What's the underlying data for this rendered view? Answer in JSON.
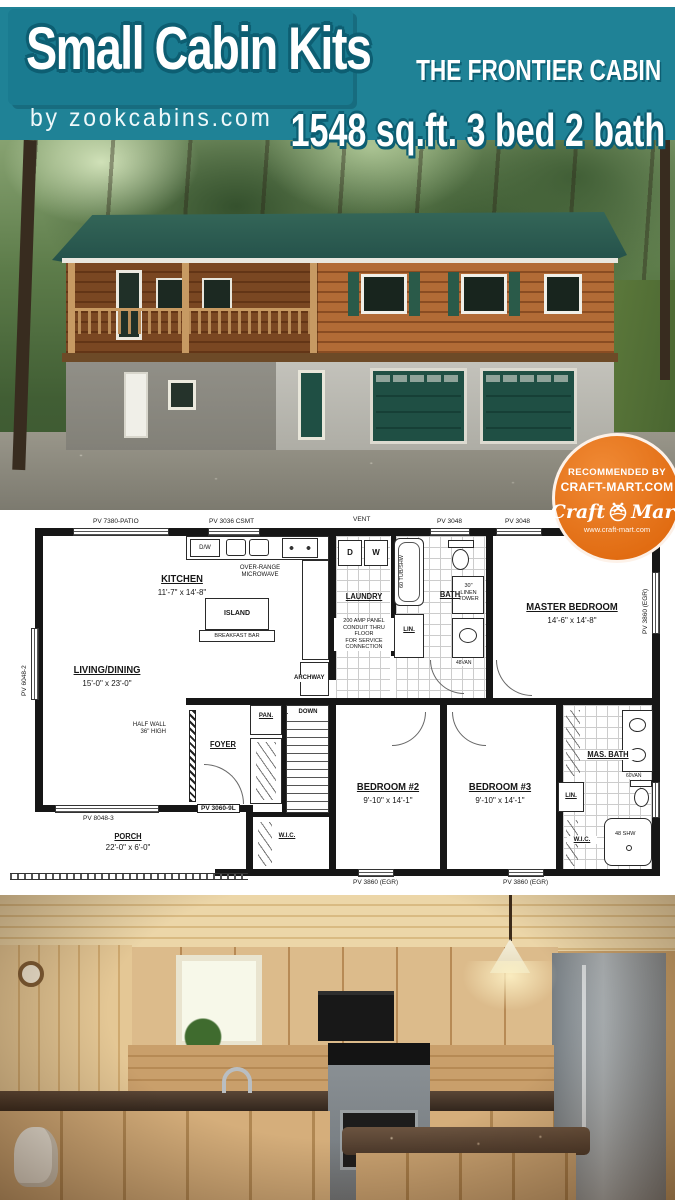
{
  "header": {
    "title": "Small Cabin Kits",
    "byline": "by zookcabins.com",
    "model_name": "THE FRONTIER CABIN",
    "specs": "1548 sq.ft. 3 bed 2 bath"
  },
  "badge": {
    "line1": "RECOMMENDED BY",
    "line2": "CRAFT-MART.COM",
    "logo_left": "Craft",
    "logo_right": "Mart",
    "url": "www.craft-mart.com"
  },
  "plan": {
    "rooms": {
      "kitchen": {
        "name": "KITCHEN",
        "dims": "11'-7\" x 14'-8\""
      },
      "living": {
        "name": "LIVING/DINING",
        "dims": "15'-0\" x 23'-0\""
      },
      "laundry": {
        "name": "LAUNDRY"
      },
      "bath": {
        "name": "BATH"
      },
      "master": {
        "name": "MASTER BEDROOM",
        "dims": "14'-6\" x 14'-8\""
      },
      "foyer": {
        "name": "FOYER"
      },
      "pantry": {
        "name": "PAN."
      },
      "porch": {
        "name": "PORCH",
        "dims": "22'-0\" x 6'-0\""
      },
      "bed2": {
        "name": "BEDROOM #2",
        "dims": "9'-10\" x 14'-1\""
      },
      "bed3": {
        "name": "BEDROOM #3",
        "dims": "9'-10\" x 14'-1\""
      },
      "masbath": {
        "name": "MAS. BATH"
      },
      "wic_bed2": {
        "name": "W.I.C."
      },
      "wic_bed3": {
        "name": "W.I.C."
      },
      "linen_hall": {
        "name": "LIN."
      },
      "linen_master": {
        "name": "LIN."
      }
    },
    "features": {
      "island": "ISLAND",
      "breakfast_bar": "BREAKFAST BAR",
      "dw": "D/W",
      "dryer": "D",
      "washer": "W",
      "microwave": "OVER-RANGE\nMICROWAVE",
      "tub": "60 TUB/SHW",
      "linen_tower": "30\"\nLINEN\nTOWER",
      "vanity48": "48VAN",
      "vanity60": "60VAN",
      "shower": "48 SHW",
      "down": "DOWN",
      "vent": "VENT",
      "archway": "ARCHWAY",
      "half_wall": "HALF WALL\n36\" HIGH",
      "amp_panel": "200 AMP PANEL\nCONDUIT THRU FLOOR\nFOR SERVICE CONNECTION"
    },
    "openings": {
      "patio_door": "PV 7380-PATIO",
      "kitchen_window": "PV 3036 CSMT",
      "bath_window": "PV 3048",
      "master_window_top": "PV 3048",
      "living_window_left": "PV 6048-2",
      "living_window_bottom": "PV 8048-3",
      "front_door": "PV 3060-9L",
      "master_window_right": "PV 3860 (EGR)",
      "bed2_window": "PV 3860 (EGR)",
      "bed3_window": "PV 3860 (EGR)"
    }
  }
}
